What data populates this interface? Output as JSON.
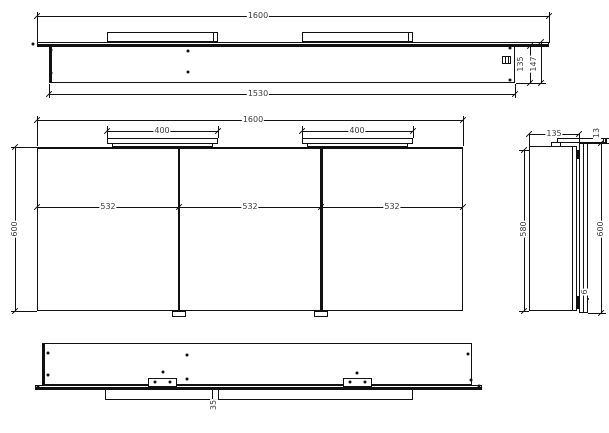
{
  "drawing_title": "mirror-cabinet-technical-drawing",
  "colors": {
    "background": "#ffffff",
    "line": "#111111",
    "text": "#3d3d3d"
  },
  "views": {
    "top": {
      "label": "top-view",
      "dims": {
        "overall_width": "1600",
        "carcass_width": "1530",
        "depth": "135",
        "total_depth": "147"
      }
    },
    "front": {
      "label": "front-view",
      "dims": {
        "overall_width": "1600",
        "light_left_width": "400",
        "light_right_width": "400",
        "compartment_left": "532",
        "compartment_middle": "532",
        "compartment_right": "532",
        "height": "600"
      }
    },
    "side": {
      "label": "side-view",
      "dims": {
        "depth": "135",
        "light_height": "13",
        "carcass_height": "580",
        "total_height": "600",
        "bottom_gap": "6"
      }
    },
    "bottom": {
      "label": "bottom-view",
      "dims": {
        "notch_width": "35"
      }
    }
  }
}
